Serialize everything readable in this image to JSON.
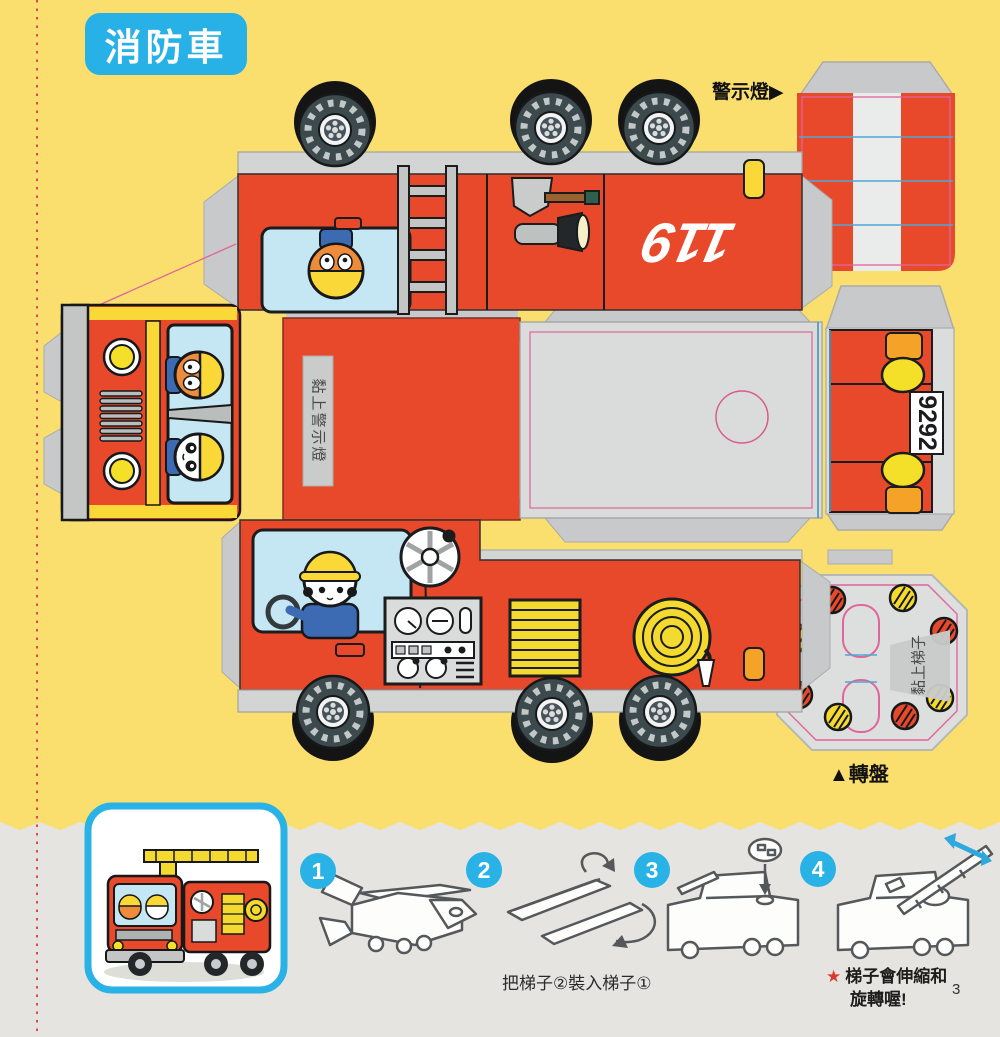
{
  "page": {
    "title": "消防車",
    "page_number": "3"
  },
  "labels": {
    "warning_light": "警示燈▶",
    "turntable": "▲轉盤",
    "paste_warning_light": "黏上警示燈",
    "paste_ladder": "黏上梯子",
    "truck_number": "119",
    "plate_number": "9292"
  },
  "instructions": {
    "steps": [
      {
        "number": "1",
        "caption": ""
      },
      {
        "number": "2",
        "caption": "把梯子②裝入梯子①"
      },
      {
        "number": "3",
        "caption": ""
      },
      {
        "number": "4",
        "caption": ""
      }
    ],
    "note_star": "★",
    "note_line1": "梯子會伸縮和",
    "note_line2": "旋轉喔!"
  },
  "colors": {
    "accent_blue": "#29B2E5",
    "truck_red": "#E8492B",
    "bg_yellow": "#FADF6F",
    "section_gray": "#E6E4E1",
    "fold_pink": "#E0659A",
    "fold_blue": "#4FA8D4"
  }
}
